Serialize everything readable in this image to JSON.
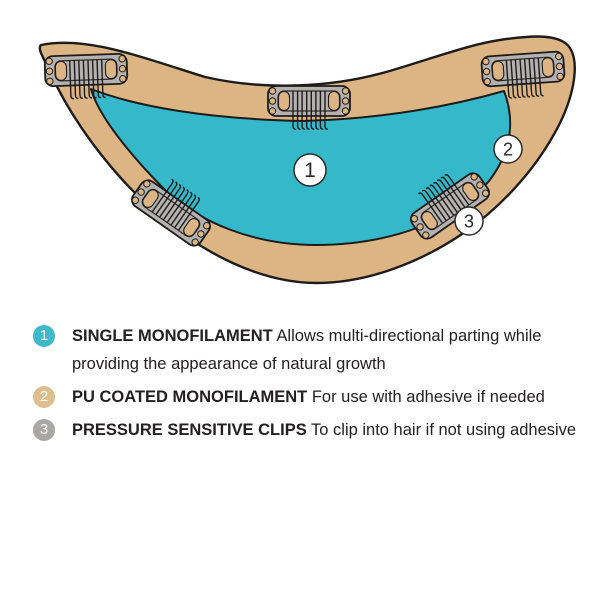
{
  "diagram": {
    "name": "wig cap construction diagram",
    "colors": {
      "cap_base": "#ddb584",
      "mono_top": "#35b8c9",
      "clip_body": "#b3b2b1",
      "outline": "#1d1c1a",
      "callout_fill": "#ffffff"
    },
    "callouts": [
      {
        "number": "1"
      },
      {
        "number": "2"
      },
      {
        "number": "3"
      }
    ]
  },
  "legend": {
    "items": [
      {
        "number": "1",
        "bullet_color": "#3db9c9",
        "label": "SINGLE MONOFILAMENT",
        "description": " Allows multi-directional parting while providing the appearance of natural growth"
      },
      {
        "number": "2",
        "bullet_color": "#ddbf8e",
        "label": "PU COATED MONOFILAMENT",
        "description": " For use with adhesive if needed"
      },
      {
        "number": "3",
        "bullet_color": "#a8a7a6",
        "label": "PRESSURE SENSITIVE CLIPS",
        "description": " To clip into hair if not using adhesive"
      }
    ]
  }
}
